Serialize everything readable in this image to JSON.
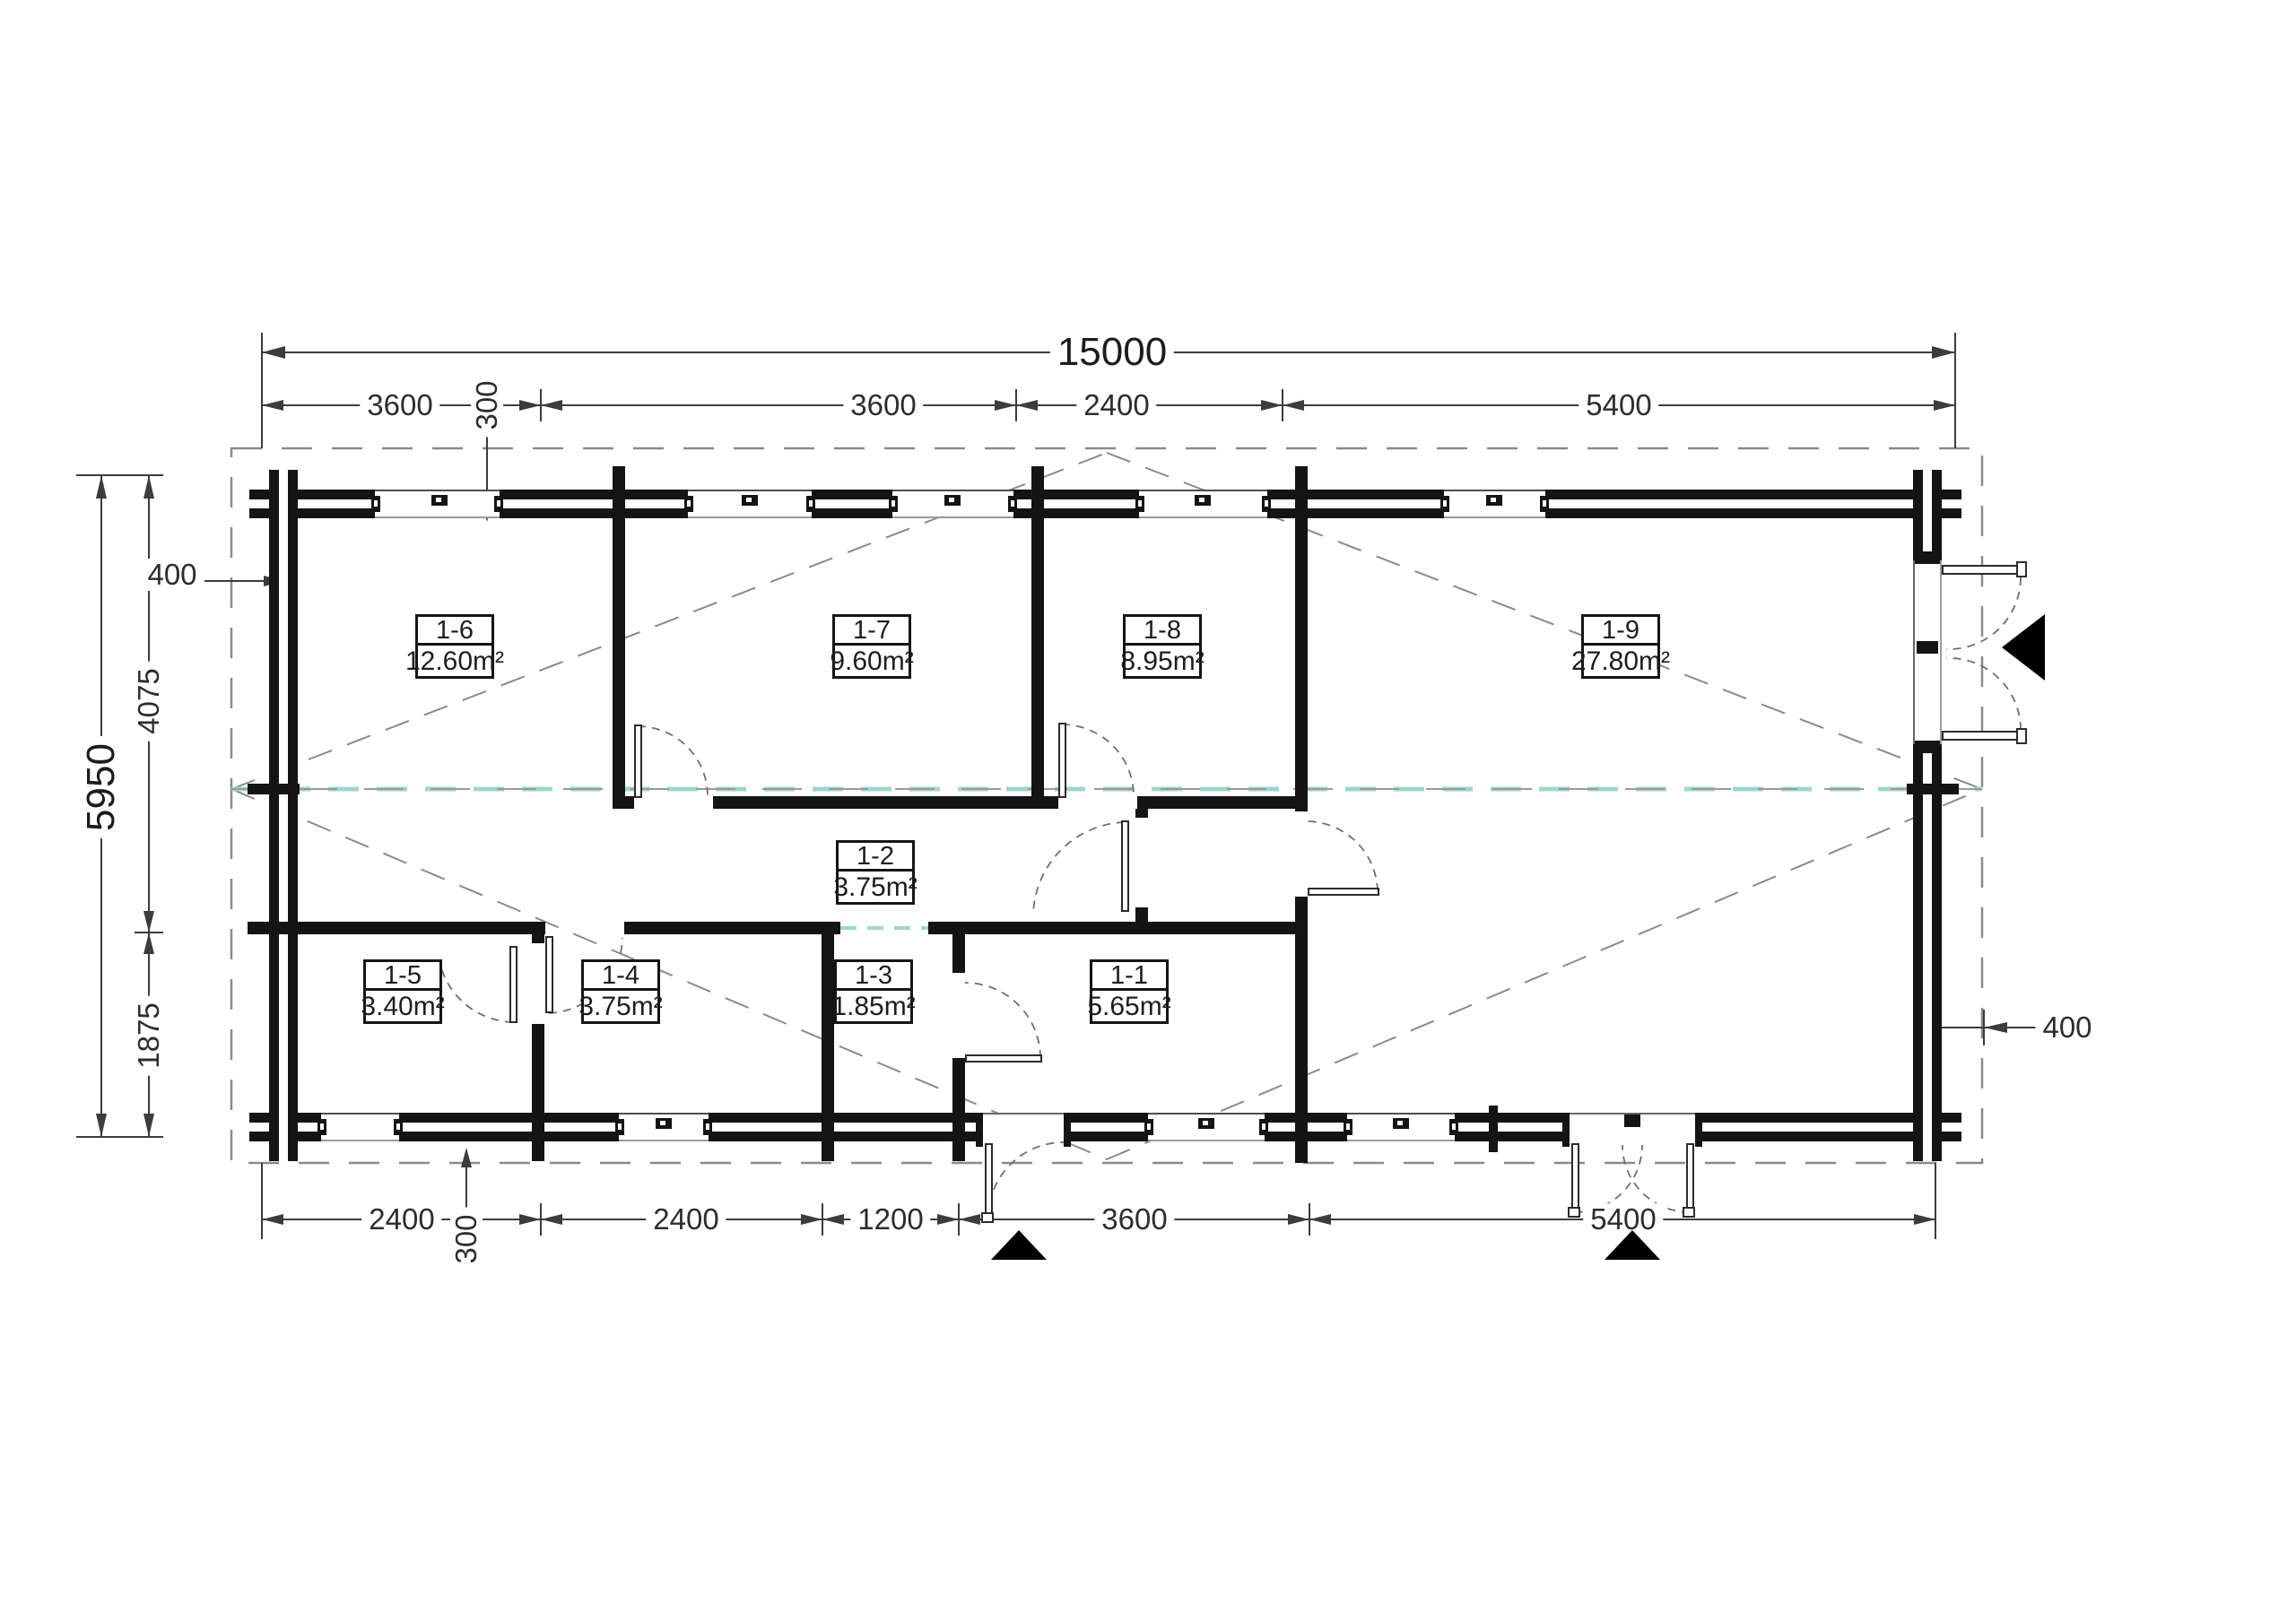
{
  "document": {
    "type": "floor-plan"
  },
  "rooms": [
    {
      "id": "1-6",
      "area": "12.60m²"
    },
    {
      "id": "1-7",
      "area": "9.60m²"
    },
    {
      "id": "1-8",
      "area": "8.95m²"
    },
    {
      "id": "1-9",
      "area": "27.80m²"
    },
    {
      "id": "1-2",
      "area": "3.75m²"
    },
    {
      "id": "1-5",
      "area": "3.40m²"
    },
    {
      "id": "1-4",
      "area": "3.75m²"
    },
    {
      "id": "1-3",
      "area": "1.85m²"
    },
    {
      "id": "1-1",
      "area": "5.65m²"
    }
  ],
  "dimensions": {
    "total_width": "15000",
    "total_height": "5950",
    "top": [
      "3600",
      "300",
      "3600",
      "2400",
      "5400"
    ],
    "bottom": [
      "2400",
      "300",
      "2400",
      "1200",
      "3600",
      "5400"
    ],
    "left": [
      "400",
      "4075",
      "1875"
    ],
    "right": [
      "400"
    ]
  },
  "colors": {
    "wall": "#141414",
    "dimension": "#3c3c3c",
    "dashed_outline": "#8a8a8a",
    "ridge_teal": "#9fd6cf",
    "entrance_marker": "#000000"
  }
}
